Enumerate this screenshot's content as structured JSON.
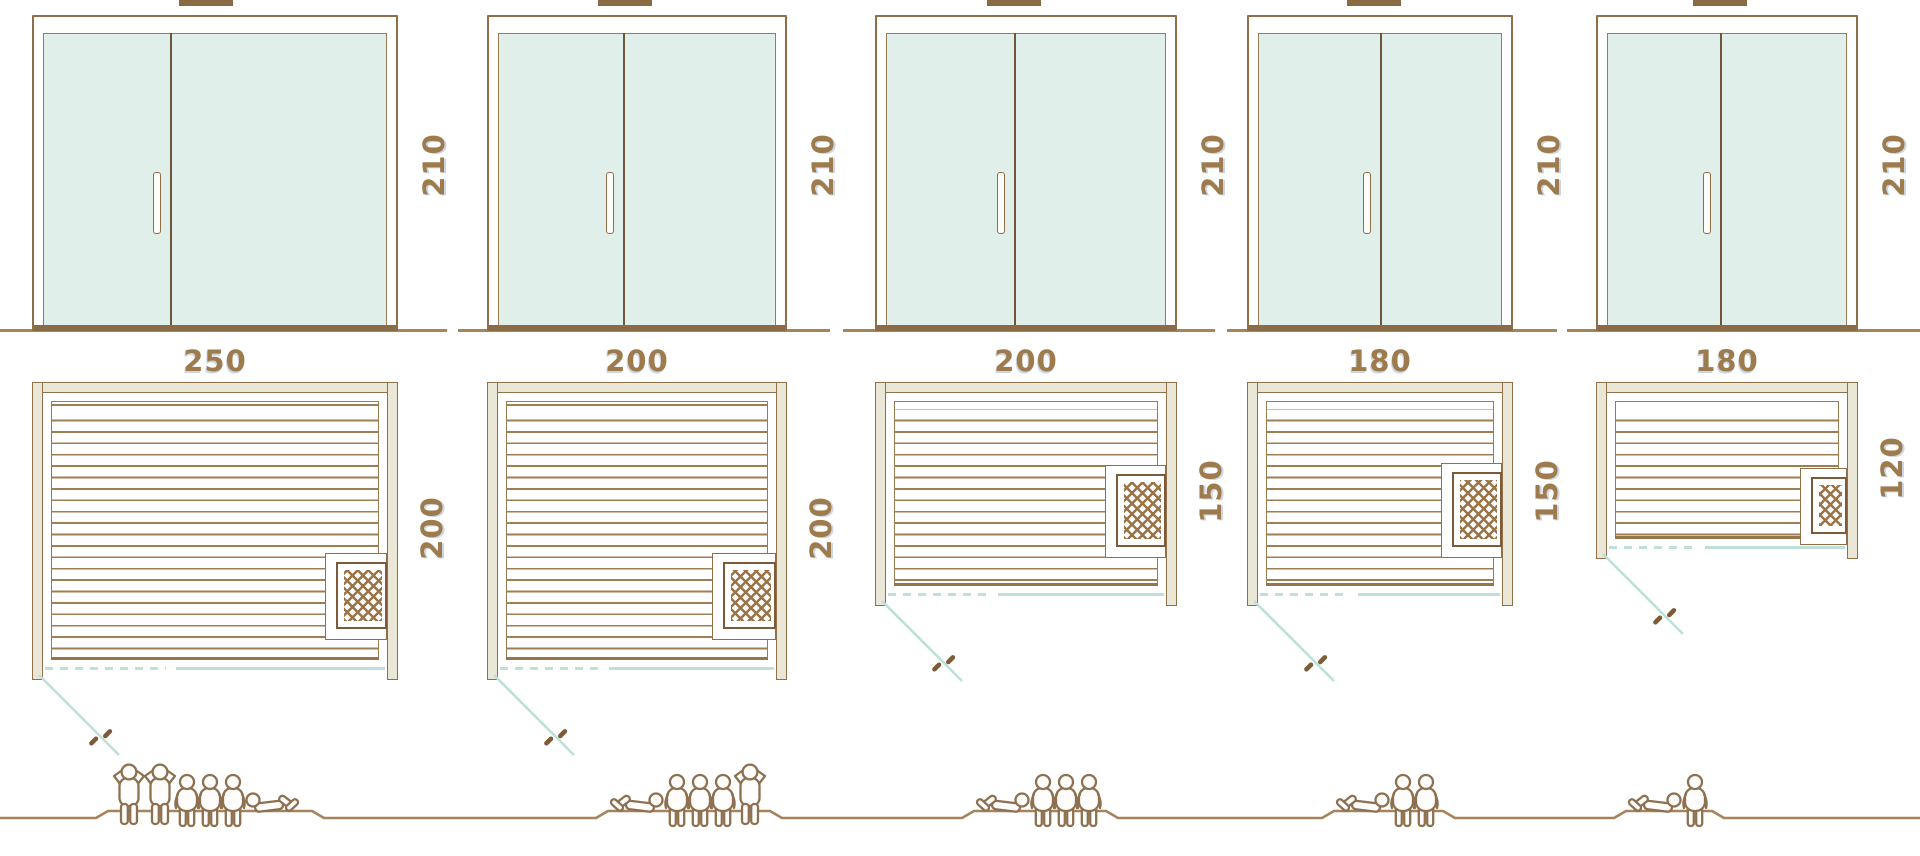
{
  "diagram": {
    "title": "Sauna cabin size comparison: door elevations, floor plans and seating capacity",
    "units": "cm"
  },
  "colors": {
    "line_brown": "#8e6f4a",
    "dark_brown": "#6f5539",
    "wall_beige": "#eae7d7",
    "glass_mint": "#e0efea",
    "door_teal": "#bfe0da",
    "label_brown": "#9d7b4c",
    "ground_brown": "#a5845c"
  },
  "columns": [
    {
      "id": "sauna-250x200",
      "labels": {
        "height": "210",
        "width": "250",
        "depth": "200"
      },
      "capacity": 6,
      "figures": [
        "standing",
        "standing",
        "seated",
        "seated",
        "seated",
        "reclining-r"
      ],
      "layout": {
        "left": 32,
        "width": 366,
        "plan_depth": 292,
        "divider_frac": 0.37,
        "chimney_offset": 36,
        "baseline": [
          0,
          447
        ],
        "heater": {
          "w": 62,
          "y0": 553,
          "y1": 640
        },
        "group_start": 112,
        "plateau": [
          108,
          312
        ]
      }
    },
    {
      "id": "sauna-200x200",
      "labels": {
        "height": "210",
        "width": "200",
        "depth": "200"
      },
      "capacity": 5,
      "figures": [
        "reclining-l",
        "seated",
        "seated",
        "seated",
        "standing"
      ],
      "layout": {
        "left": 487,
        "width": 300,
        "plan_depth": 292,
        "divider_frac": 0.45,
        "chimney_offset": 2,
        "baseline": [
          458,
          830
        ],
        "heater": {
          "w": 64,
          "y0": 553,
          "y1": 640
        },
        "group_start": 612,
        "plateau": [
          608,
          770
        ]
      }
    },
    {
      "id": "sauna-200x150",
      "labels": {
        "height": "210",
        "width": "200",
        "depth": "150"
      },
      "capacity": 4,
      "figures": [
        "reclining-l",
        "seated",
        "seated",
        "seated"
      ],
      "layout": {
        "left": 875,
        "width": 302,
        "plan_depth": 218,
        "divider_frac": 0.458,
        "chimney_offset": 0,
        "baseline": [
          843,
          1215
        ],
        "heater": {
          "w": 61,
          "y0": 465,
          "y1": 558
        },
        "group_start": 978,
        "plateau": [
          974,
          1106
        ]
      }
    },
    {
      "id": "sauna-180x150",
      "labels": {
        "height": "210",
        "width": "180",
        "depth": "150"
      },
      "capacity": 3,
      "figures": [
        "reclining-l",
        "seated",
        "seated"
      ],
      "layout": {
        "left": 1247,
        "width": 266,
        "plan_depth": 218,
        "divider_frac": 0.5,
        "chimney_offset": -6,
        "baseline": [
          1227,
          1557
        ],
        "heater": {
          "w": 61,
          "y0": 463,
          "y1": 558
        },
        "group_start": 1338,
        "plateau": [
          1334,
          1443
        ]
      }
    },
    {
      "id": "sauna-180x120",
      "labels": {
        "height": "210",
        "width": "180",
        "depth": "120"
      },
      "capacity": 2,
      "figures": [
        "reclining-l",
        "seated"
      ],
      "layout": {
        "left": 1596,
        "width": 262,
        "plan_depth": 171,
        "divider_frac": 0.47,
        "chimney_offset": 0,
        "baseline": [
          1567,
          1920
        ],
        "heater": {
          "w": 47,
          "y0": 468,
          "y1": 545
        },
        "group_start": 1630,
        "plateau": [
          1626,
          1712
        ]
      }
    }
  ]
}
